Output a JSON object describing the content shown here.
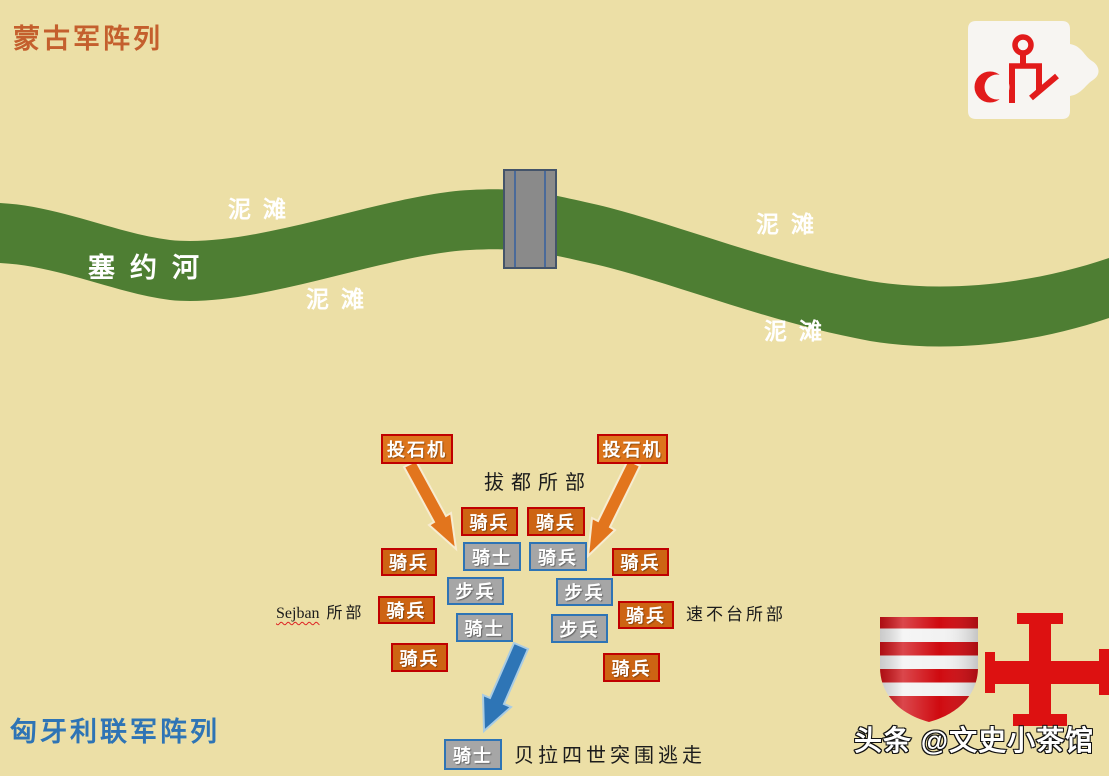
{
  "titles": {
    "mongol_army": "蒙古军阵列",
    "hungarian_army": "匈牙利联军阵列"
  },
  "river": {
    "name": "塞约河",
    "mudflat": "泥滩"
  },
  "labels": {
    "catapult": "投石机",
    "cavalry": "骑兵",
    "knight": "骑士",
    "infantry": "步兵"
  },
  "annotations": {
    "batu": "拔都所部",
    "sejban_name": "Sejban",
    "sejban_suffix": "所部",
    "subutai": "速不台所部",
    "bela_escape": "贝拉四世突围逃走"
  },
  "watermark": "头条 @文史小茶馆",
  "icons": {
    "logo": "tamga-seal-logo",
    "shield": "arpad-stripes-shield-icon",
    "cross": "red-cross-icon",
    "bridge": "bridge",
    "orange_attack_arrows": "catapult-fire-arrows",
    "blue_escape_arrow": "escape-arrow"
  },
  "colors": {
    "background": "#ecdfa6",
    "river_green": "#4e7e33",
    "mongol_orange": "#cd6413",
    "catapult_orange": "#dd751c",
    "mongol_border_red": "#c00000",
    "hungarian_gray": "#a6a6a6",
    "hungarian_border_blue": "#2e74b5",
    "escape_arrow_blue": "#2e75b6",
    "heraldry_red": "#dd1111",
    "title_orange": "#c45f2d",
    "title_blue": "#2e74b5"
  }
}
